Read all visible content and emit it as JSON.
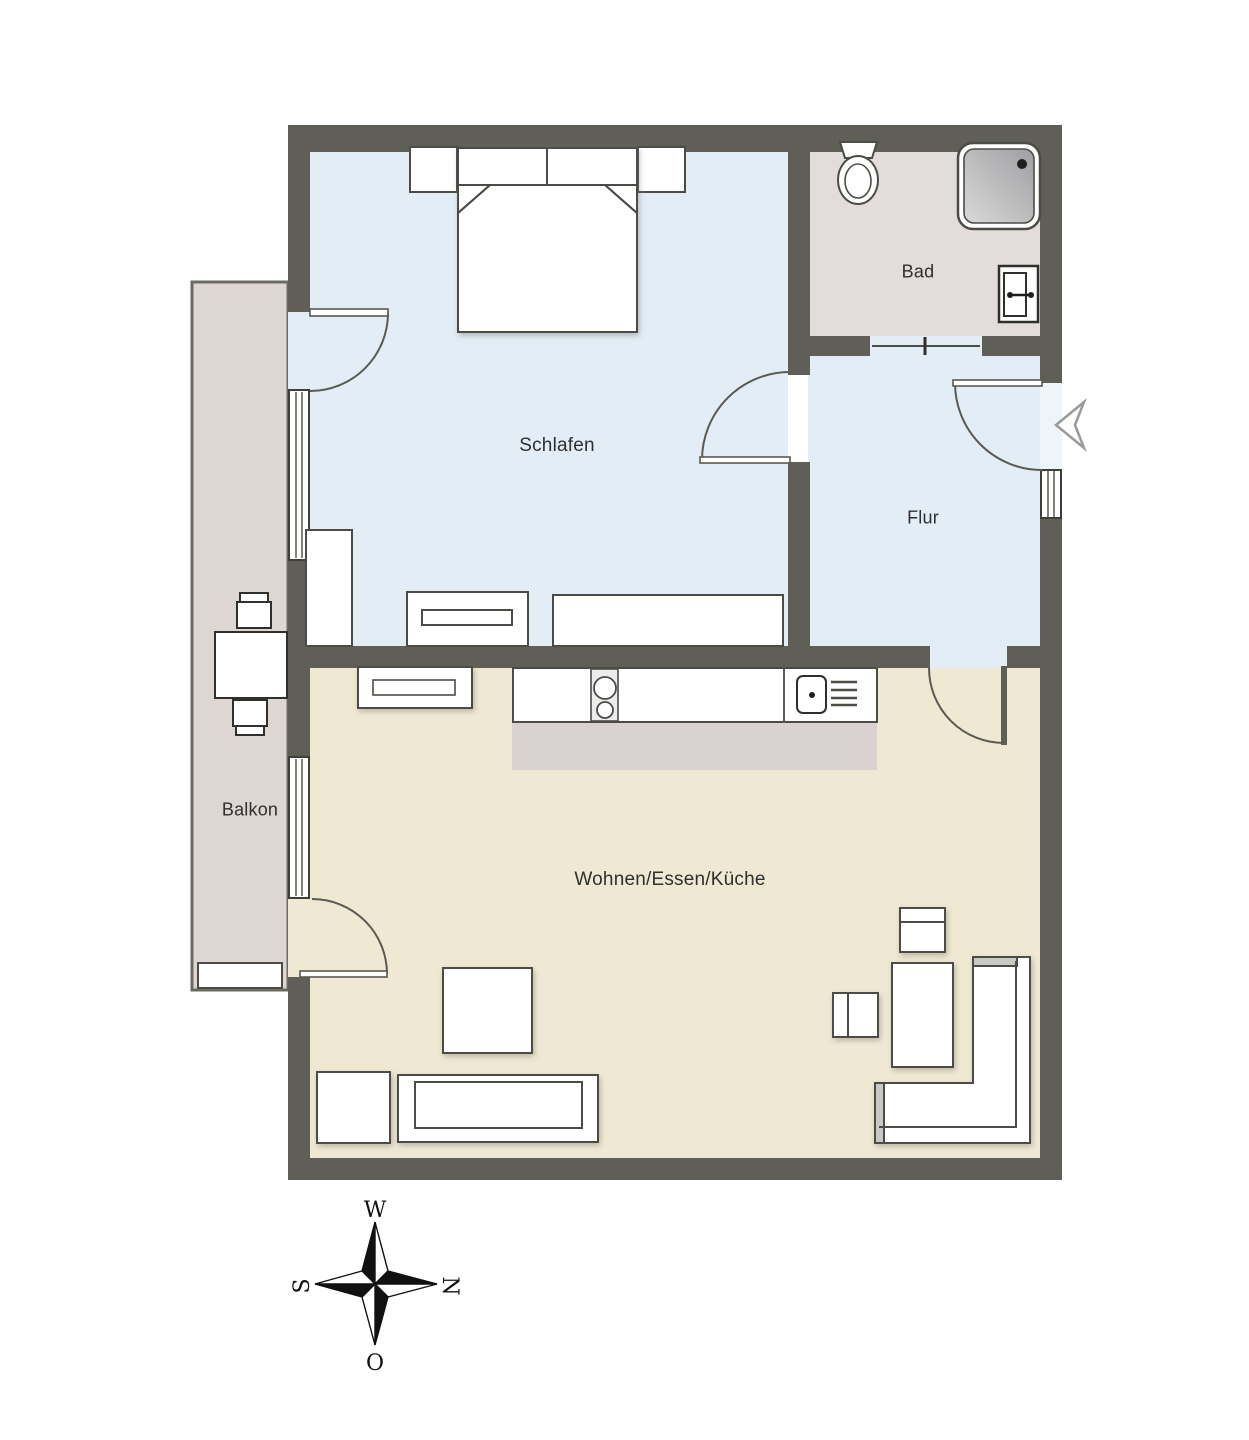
{
  "plan": {
    "title": "Apartment floor plan (Grundriss)",
    "rooms": {
      "schlafen": {
        "label": "Schlafen"
      },
      "bad": {
        "label": "Bad"
      },
      "flur": {
        "label": "Flur"
      },
      "wohnen": {
        "label": "Wohnen/Essen/Küche"
      },
      "balkon": {
        "label": "Balkon"
      }
    },
    "compass": {
      "top": "W",
      "right": "N",
      "bottom": "O",
      "left": "S"
    },
    "colors": {
      "wall": "#5f5f58",
      "bedroom_hall_floor": "#e2edf6",
      "living_floor": "#efe9d3",
      "bath_floor": "#e2dddb",
      "balcony_floor": "#ddd6d3",
      "kitchen_zone": "#d9d2d0",
      "furniture_outline": "#4c4c46",
      "furniture_fill": "#ffffff",
      "label_text": "#2f2f2f"
    },
    "features": {
      "doors": [
        "balcony-door-bedroom",
        "bedroom-hall-door",
        "entrance-door",
        "hall-living-door",
        "balcony-door-living",
        "bath-doorway"
      ],
      "windows": [
        "bedroom-window",
        "living-window",
        "entrance-side-window"
      ],
      "bath_fixtures": [
        "toilet",
        "shower",
        "wash-basin"
      ],
      "kitchen_fixtures": [
        "cooktop",
        "kitchen-sink",
        "counter",
        "sideboard"
      ],
      "bedroom_furniture": [
        "double-bed",
        "nightstand-left",
        "nightstand-right",
        "wardrobe",
        "dresser",
        "sideboard-low"
      ],
      "living_furniture": [
        "sofa",
        "corner-sofa",
        "armchair",
        "coffee-table",
        "coffee-table-2",
        "side-table",
        "square-table"
      ],
      "balcony_furniture": [
        "balcony-table",
        "balcony-chair-top",
        "balcony-chair-bottom",
        "planter-bench"
      ]
    }
  }
}
